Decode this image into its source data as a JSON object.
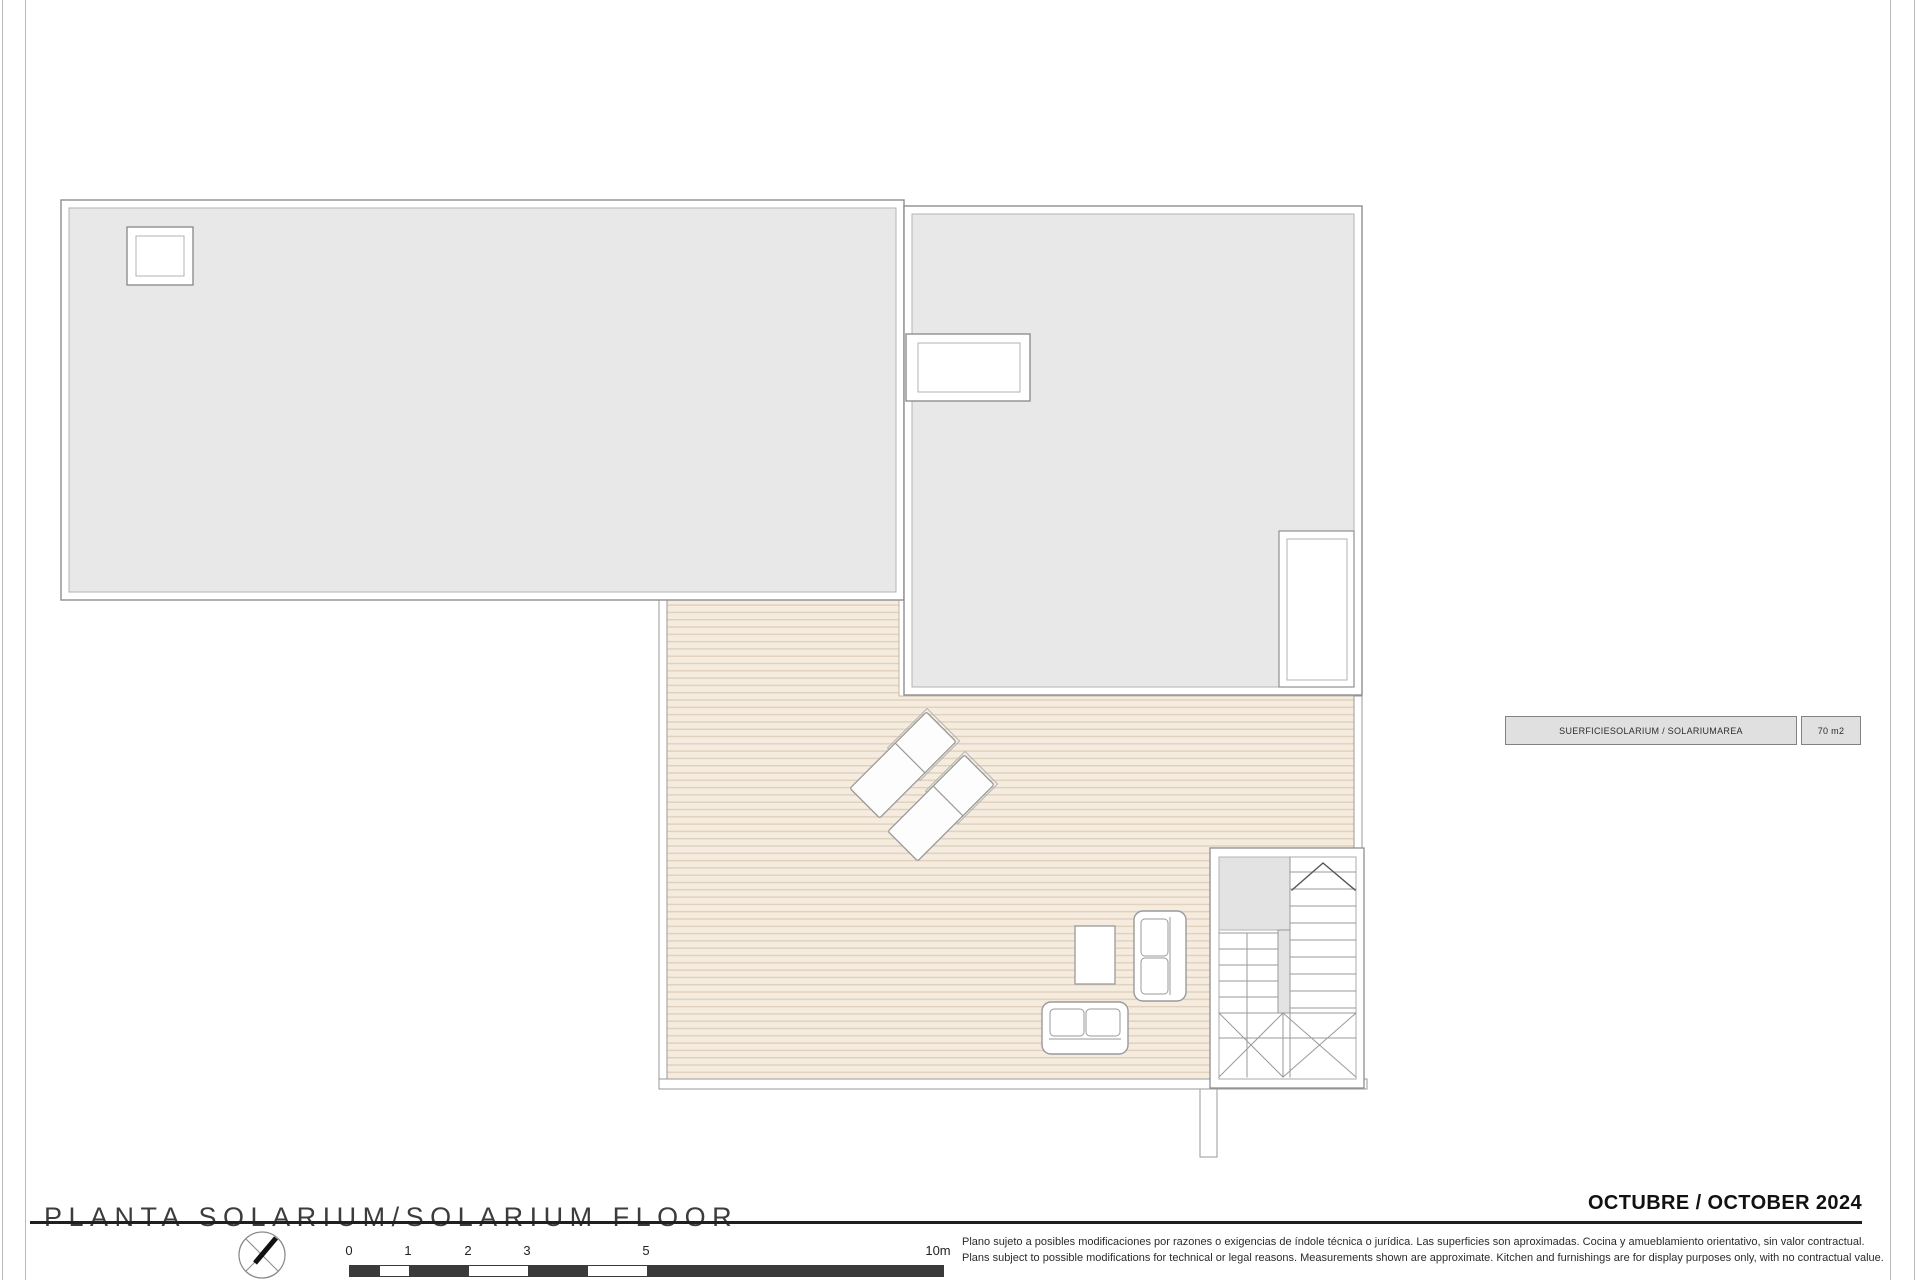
{
  "title_block": {
    "title": "PLANTA SOLARIUM/SOLARIUM FLOOR",
    "date": "OCTUBRE / OCTOBER 2024"
  },
  "area_table": {
    "label": "SUERFICIESOLARIUM / SOLARIUMAREA",
    "value": "70 m2"
  },
  "scale_bar": {
    "labels": [
      "0",
      "1",
      "2",
      "3",
      "5",
      "10m"
    ]
  },
  "disclaimer": {
    "line_es": "Plano sujeto a posibles modificaciones por razones o exigencias de índole técnica o jurídica. Las superficies son aproximadas. Cocina y amueblamiento orientativo, sin valor contractual.",
    "line_en": "Plans subject to possible modifications for technical or legal reasons. Measurements shown are approximate. Kitchen and furnishings are for display purposes only, with no contractual value."
  },
  "colors": {
    "roof_fill": "#e8e8e8",
    "deck_fill": "#f5ecdf",
    "deck_stripe": "#e0d0bc",
    "stair_fill": "#e3e3e3",
    "wall_line": "#9a9a9a",
    "scalebar_dark": "#3a3a3a"
  }
}
